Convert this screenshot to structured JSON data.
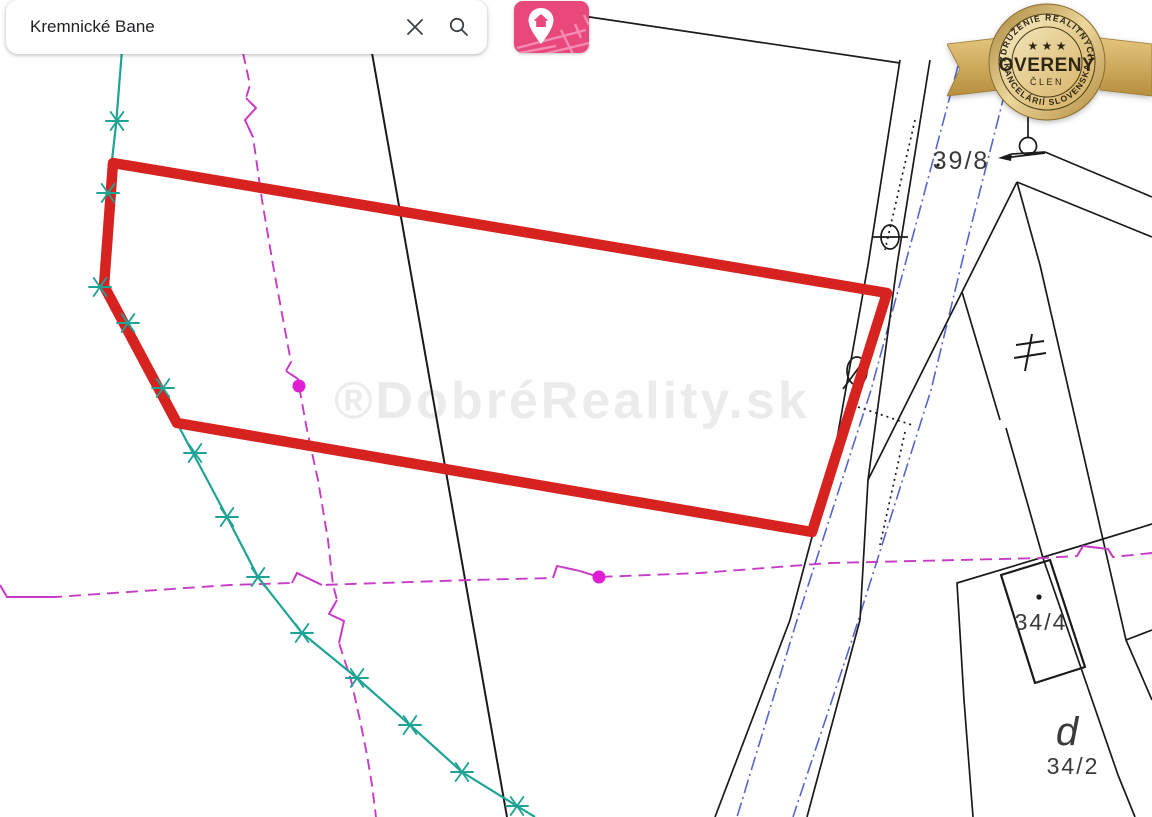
{
  "search_bar": {
    "query": "Kremnické Bane"
  },
  "map_button": {
    "icon": "map-with-location-pin"
  },
  "badge": {
    "arc_top": "ZDRUŽENIE REALITNÝCH",
    "arc_bottom": "KANCELÁRIÍ SLOVENSKA",
    "stars": "★ ★ ★",
    "title": "OVERENÝ",
    "subtitle": "ČLEN"
  },
  "watermark": {
    "text": "®DobréReality.sk"
  },
  "map": {
    "labels": [
      {
        "id": "parcel-39-8",
        "text": "39/8",
        "x": 961,
        "y": 169,
        "size": 25,
        "italic": false
      },
      {
        "id": "parcel-34-4",
        "text": "34/4",
        "x": 1041,
        "y": 630,
        "size": 23,
        "italic": false
      },
      {
        "id": "parcel-d",
        "text": "d",
        "x": 1068,
        "y": 745,
        "size": 40,
        "italic": true
      },
      {
        "id": "parcel-34-2",
        "text": "34/2",
        "x": 1073,
        "y": 774,
        "size": 23,
        "italic": false
      }
    ],
    "colors": {
      "highlight_red": "#d7231f",
      "cadastral_teal": "#1fa396",
      "boundary_magenta": "#c73bc7",
      "dot_magenta": "#e01fd3",
      "easement_blue": "#5566cc",
      "line_black": "#1a1a1a",
      "brand_pink": "#e8487c",
      "watermark_gray": "#ebebeb"
    },
    "teal_stars": [
      [
        117,
        121
      ],
      [
        108,
        193
      ],
      [
        100,
        287
      ],
      [
        128,
        323
      ],
      [
        163,
        388
      ],
      [
        195,
        453
      ],
      [
        227,
        517
      ],
      [
        258,
        577
      ],
      [
        302,
        633
      ],
      [
        357,
        678
      ],
      [
        410,
        725
      ],
      [
        462,
        772
      ],
      [
        517,
        806
      ]
    ],
    "magenta_dots": [
      [
        299,
        386
      ],
      [
        599,
        577
      ]
    ]
  }
}
